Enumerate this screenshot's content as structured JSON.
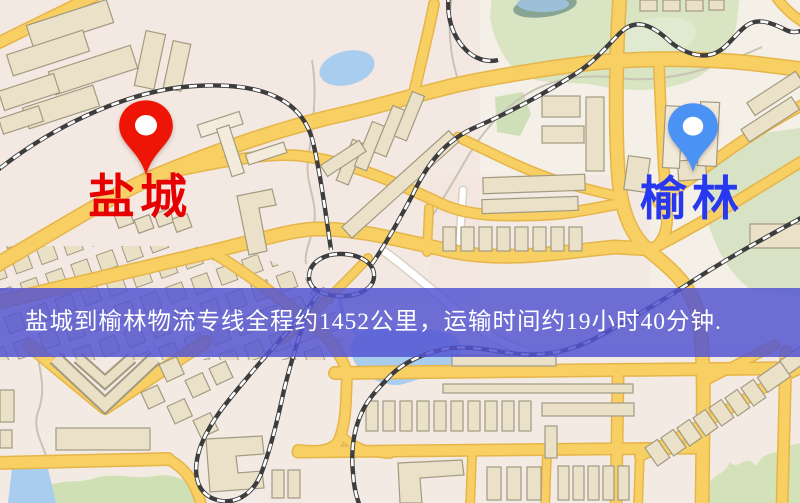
{
  "banner": {
    "text": "盐城到榆林物流专线全程约1452公里，运输时间约19小时40分钟.",
    "origin_city": "盐城",
    "destination_city": "榆林",
    "distance_km": "1452",
    "duration": "19小时40分钟",
    "background_color": "#5254d1",
    "text_color": "#ffffff"
  },
  "markers": {
    "origin": {
      "label": "盐城",
      "pin_color": "#ee1506",
      "label_color": "#e60000",
      "icon": "red-map-pin-icon"
    },
    "destination": {
      "label": "榆林",
      "pin_color": "#4b92f5",
      "label_color": "#2738ee",
      "icon": "blue-map-pin-icon"
    }
  },
  "map": {
    "style": "street-map",
    "colors": {
      "background": "#f4efe7",
      "road": "#f7cf63",
      "road_casing": "#e6b54a",
      "railway": "#3d3d3d",
      "water": "#a8cdee",
      "park": "#d8e4c2",
      "building": "#eae1c8"
    }
  }
}
